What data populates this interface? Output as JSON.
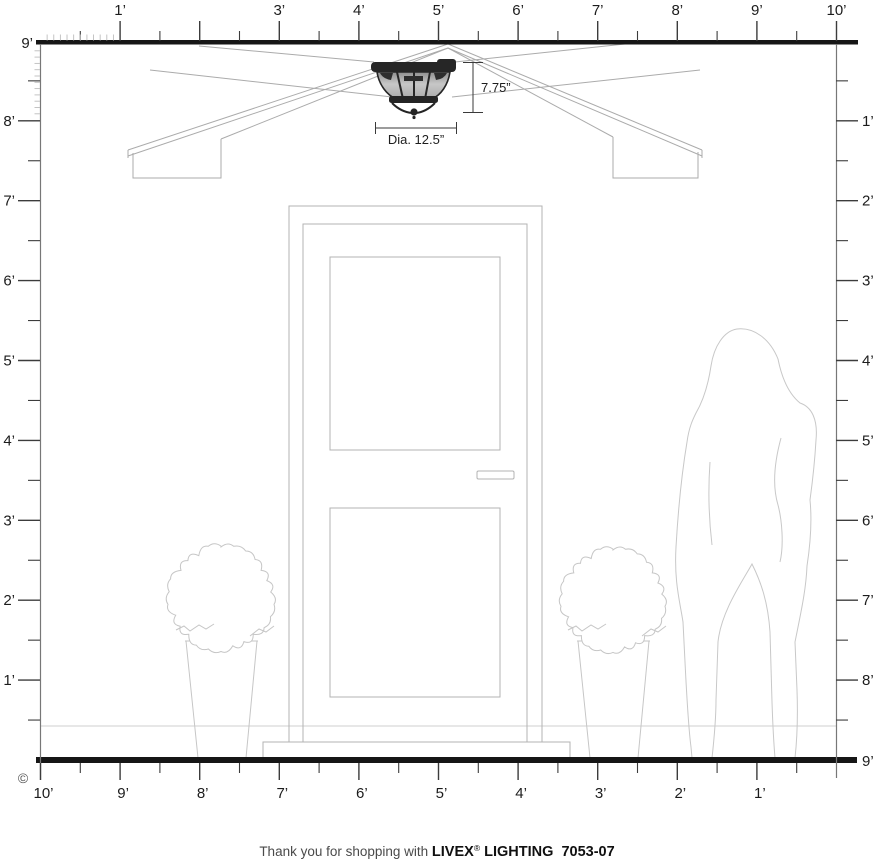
{
  "rulers": {
    "top": {
      "labels": [
        {
          "v": 1,
          "t": "1’"
        },
        {
          "v": 3,
          "t": "3’"
        },
        {
          "v": 4,
          "t": "4’"
        },
        {
          "v": 5,
          "t": "5’"
        },
        {
          "v": 6,
          "t": "6’"
        },
        {
          "v": 7,
          "t": "7’"
        },
        {
          "v": 8,
          "t": "8’"
        },
        {
          "v": 9,
          "t": "9’"
        },
        {
          "v": 10,
          "t": "10’"
        }
      ]
    },
    "left": {
      "top_label": "9’",
      "labels": [
        {
          "v": 8,
          "t": "8’"
        },
        {
          "v": 7,
          "t": "7’"
        },
        {
          "v": 6,
          "t": "6’"
        },
        {
          "v": 5,
          "t": "5’"
        },
        {
          "v": 4,
          "t": "4’"
        },
        {
          "v": 3,
          "t": "3’"
        },
        {
          "v": 2,
          "t": "2’"
        },
        {
          "v": 1,
          "t": "1’"
        }
      ]
    },
    "right": {
      "bottom_label": "9’",
      "labels": [
        {
          "v": 1,
          "t": "1’"
        },
        {
          "v": 2,
          "t": "2’"
        },
        {
          "v": 3,
          "t": "3’"
        },
        {
          "v": 4,
          "t": "4’"
        },
        {
          "v": 5,
          "t": "5’"
        },
        {
          "v": 6,
          "t": "6’"
        },
        {
          "v": 7,
          "t": "7’"
        },
        {
          "v": 8,
          "t": "8’"
        }
      ]
    },
    "bottom": {
      "labels": [
        {
          "v": 10,
          "t": "10’"
        },
        {
          "v": 9,
          "t": "9’"
        },
        {
          "v": 8,
          "t": "8’"
        },
        {
          "v": 7,
          "t": "7’"
        },
        {
          "v": 6,
          "t": "6’"
        },
        {
          "v": 5,
          "t": "5’"
        },
        {
          "v": 4,
          "t": "4’"
        },
        {
          "v": 3,
          "t": "3’"
        },
        {
          "v": 2,
          "t": "2’"
        },
        {
          "v": 1,
          "t": "1’"
        }
      ]
    }
  },
  "fixture": {
    "height_label": "7.75”",
    "diameter_label": "Dia. 12.5”"
  },
  "copyright": "©",
  "footer": {
    "prefix": "Thank you for shopping with ",
    "brand": "LIVEX",
    "registered": "®",
    "suffix": " LIGHTING  7053-07"
  },
  "colors": {
    "bar": "#161616",
    "ruler_tick": "#3c3c3c",
    "ruler_text": "#1c1c1c",
    "hatch": "#bdbdbd",
    "drawing_line": "#ababab",
    "light_line": "#c6c6c6",
    "floor_line": "#cfcfcf",
    "fixture_dark": "#262626",
    "dim_line": "#3a3a3a",
    "footer_text": "#4a4a4a",
    "footer_brand": "#101010"
  }
}
